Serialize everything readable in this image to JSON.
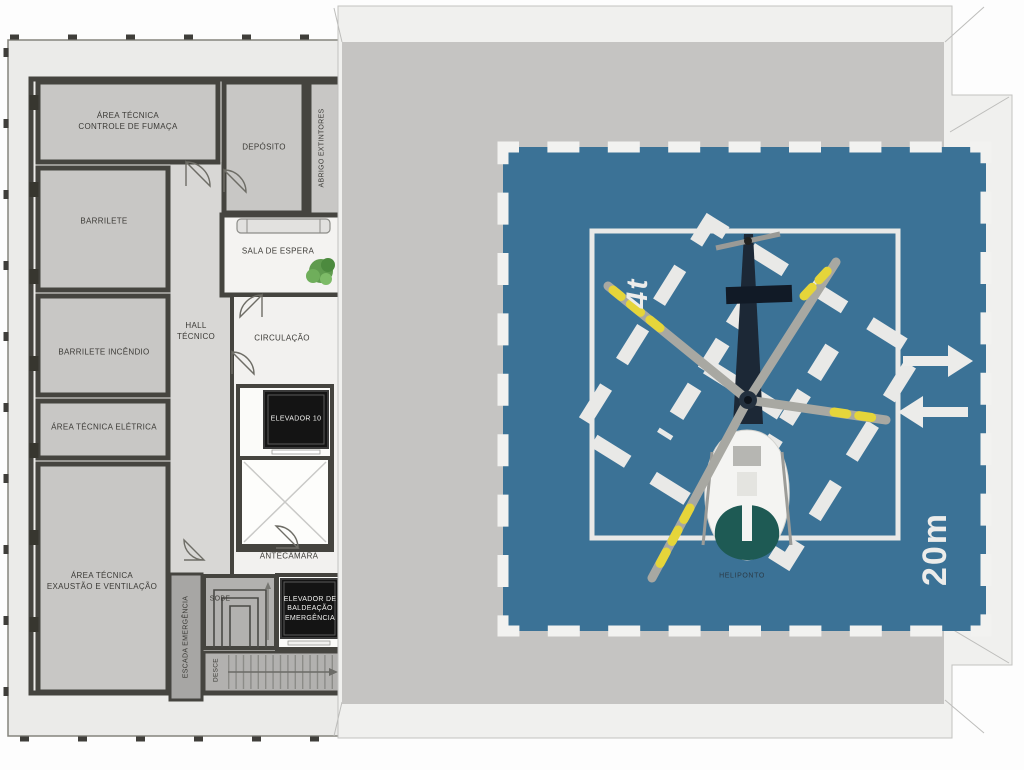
{
  "plan": {
    "rooms": {
      "controle_fumaca": "ÁREA TÉCNICA\nCONTROLE DE FUMAÇA",
      "barrilete": "BARRILETE",
      "deposito": "DEPÓSITO",
      "abrigo_extintores": "ABRIGO EXTINTORES",
      "sala_espera": "SALA DE ESPERA",
      "hall_tecnico": "HALL\nTÉCNICO",
      "circulacao": "CIRCULAÇÃO",
      "barrilete_incendio": "BARRILETE INCÊNDIO",
      "area_eletrica": "ÁREA TÉCNICA ELÉTRICA",
      "elevador_10": "ELEVADOR 10",
      "antecamara": "ANTECÂMARA",
      "exaustao": "ÁREA TÉCNICA\nEXAUSTÃO E VENTILAÇÃO",
      "sobe": "SOBE",
      "escada_emergencia": "ESCADA EMERGÊNCIA",
      "elevador_baldeacao": "ELEVADOR DE\nBALDEAÇÃO\nEMERGÊNCIA",
      "desce": "DESCE"
    }
  },
  "helipad": {
    "label": "HELIPONTO",
    "weight_limit": "4t",
    "dimension": "20m",
    "surface_color": "#3b7296",
    "marking_color": "#ebebe9",
    "roof_color": "#c5c4c2"
  }
}
